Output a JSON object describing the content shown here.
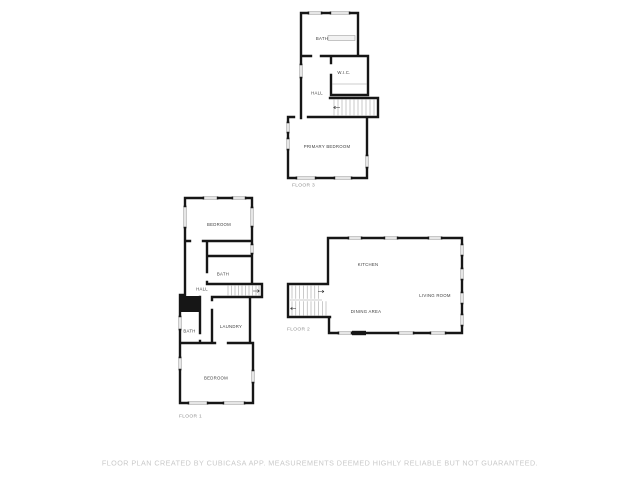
{
  "image_type": "floor-plan",
  "disclaimer": "FLOOR PLAN CREATED BY CUBICASA APP. MEASUREMENTS DEEMED HIGHLY RELIABLE BUT NOT GUARANTEED.",
  "colors": {
    "background": "#ffffff",
    "wall": "#161616",
    "window_frame": "#9a9a9a",
    "room_label": "#3d3d3d",
    "floor_label": "#8f8f8f",
    "disclaimer_text": "#c9c9c9"
  },
  "floor3": {
    "label": "FLOOR 3",
    "rooms": {
      "bath": "BATH",
      "wic": "W.I.C.",
      "hall": "HALL",
      "primary_bedroom": "PRIMARY BEDROOM"
    }
  },
  "floor1": {
    "label": "FLOOR 1",
    "rooms": {
      "bedroom_upper": "BEDROOM",
      "bath_upper": "BATH",
      "hall": "HALL",
      "laundry": "LAUNDRY",
      "bath_lower": "BATH",
      "bedroom_lower": "BEDROOM"
    }
  },
  "floor2": {
    "label": "FLOOR 2",
    "rooms": {
      "kitchen": "KITCHEN",
      "living_room": "LIVING ROOM",
      "dining_area": "DINING AREA"
    }
  }
}
